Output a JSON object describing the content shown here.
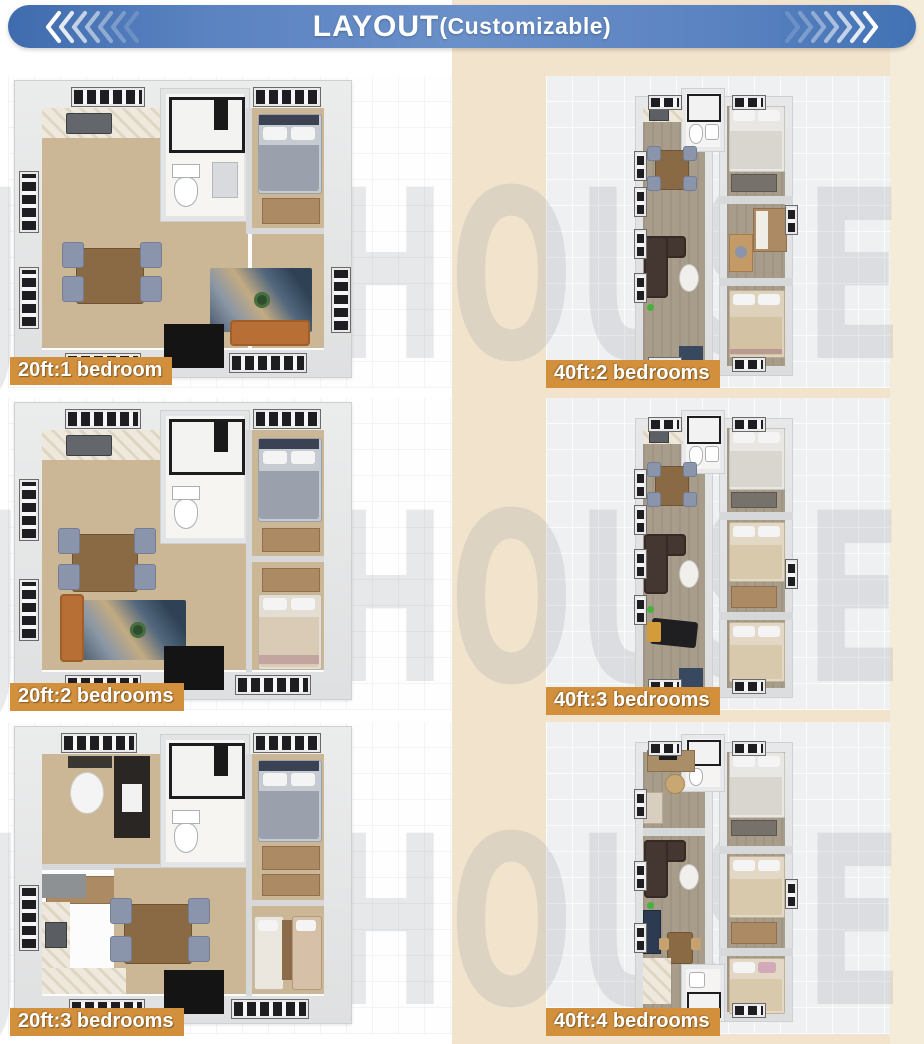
{
  "header": {
    "title": "LAYOUT",
    "subtitle": "(Customizable)"
  },
  "watermark": {
    "text": "JOY HOUSE"
  },
  "columns": {
    "left": {
      "plans": [
        {
          "label": "20ft:1 bedroom",
          "size": "20ft",
          "bedrooms": 1
        },
        {
          "label": "20ft:2 bedrooms",
          "size": "20ft",
          "bedrooms": 2
        },
        {
          "label": "20ft:3 bedrooms",
          "size": "20ft",
          "bedrooms": 3
        }
      ]
    },
    "right": {
      "plans": [
        {
          "label": "40ft:2 bedrooms",
          "size": "40ft",
          "bedrooms": 2
        },
        {
          "label": "40ft:3 bedrooms",
          "size": "40ft",
          "bedrooms": 3
        },
        {
          "label": "40ft:4 bedrooms",
          "size": "40ft",
          "bedrooms": 4
        }
      ]
    }
  },
  "colors": {
    "banner_blue": "#5b83c1",
    "label_orange": "#d28f3c",
    "panel_tan": "#f1e3cc",
    "card_gray": "#eff0f2",
    "floor_wood_20ft": "#cbb795",
    "floor_wood_40ft": "#a89d8b"
  }
}
